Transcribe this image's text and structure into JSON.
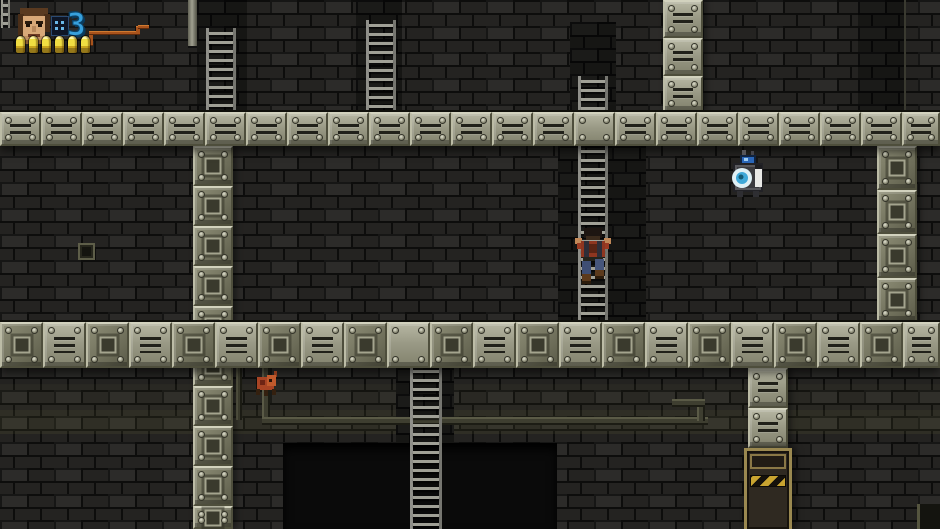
{
  "meta": {
    "app": "pixel-platformer-game",
    "scene": "industrial-brick-tower-level"
  },
  "hud": {
    "portrait_icon": "soldier-face",
    "grenade_counter": {
      "icon": "grenade-pack-icon",
      "value": "3"
    },
    "ammo": {
      "icon": "bullet-icon",
      "count": 6
    }
  },
  "entities": {
    "player": "soldier-climbing-ladder",
    "drone": "hover-drone-enemy",
    "crawler": "small-red-crawler-enemy",
    "exit_door": "hazard-striped-door"
  },
  "colors": {
    "hud_blue": "#37a0dc",
    "ammo_yellow": "#ecd83a",
    "hazard_yellow": "#c9a430",
    "drone_eye_blue": "#46b4e0",
    "crawler_orange": "#b04a28",
    "pipe_orange": "#a8531c"
  }
}
